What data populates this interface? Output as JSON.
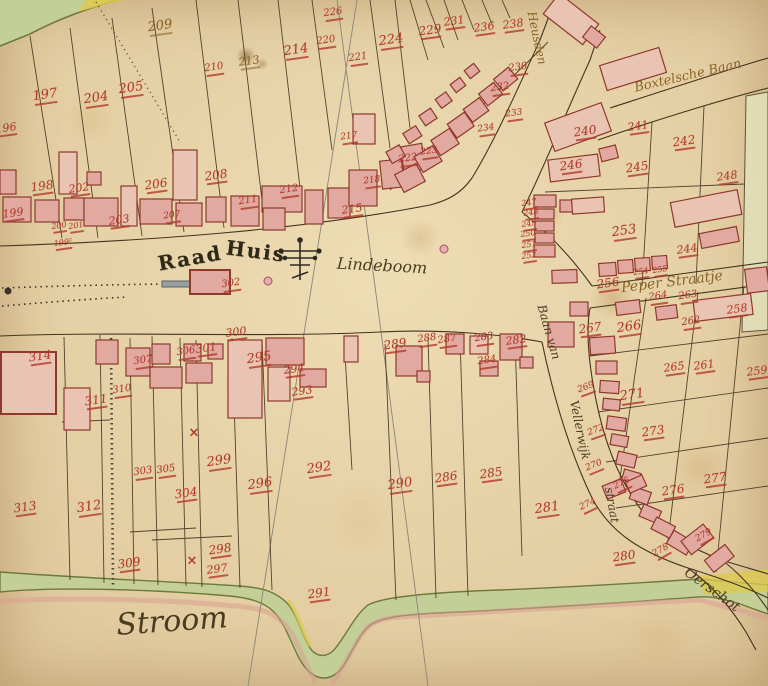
{
  "palette": {
    "paper": "#e7d2a6",
    "line_ink": "#43351f",
    "red_ink": "#b23a2c",
    "brown_ink": "#8a6428",
    "dark_ink": "#332d22",
    "building_fill": "#e2a9a1",
    "building_pale": "#eac4b2",
    "building_stroke": "#8e392e",
    "green_fill": "#c3cf97",
    "green_edge": "#6d7a3a",
    "yellow_fill": "#ddc94e",
    "grey_line": "#8b857a",
    "pink_wash": "#d89e94"
  },
  "map": {
    "place_labels": [
      {
        "name": "raad-huis-label-1",
        "text": "Raad",
        "x": 190,
        "y": 258,
        "rot": -10,
        "size": 20,
        "cls": "blackletter"
      },
      {
        "name": "raad-huis-label-2",
        "text": "Huis",
        "x": 256,
        "y": 251,
        "rot": 7,
        "size": 20,
        "cls": "blackletter"
      },
      {
        "name": "lindeboom-label",
        "text": "Lindeboom",
        "x": 382,
        "y": 266,
        "rot": 3,
        "size": 16,
        "cls": "script"
      },
      {
        "name": "stroom-label",
        "text": "Stroom",
        "x": 172,
        "y": 622,
        "rot": -4,
        "size": 30,
        "cls": "script"
      },
      {
        "name": "peper-straatje-label",
        "text": "Peper Straatje",
        "x": 672,
        "y": 282,
        "rot": -7,
        "size": 14,
        "cls": "script-brown"
      },
      {
        "name": "boxtelsche-baan-label",
        "text": "Boxtelsche Baan",
        "x": 688,
        "y": 76,
        "rot": -13,
        "size": 13,
        "cls": "script-brown"
      },
      {
        "name": "heusden-street-label",
        "text": "Heusden",
        "x": 537,
        "y": 38,
        "rot": 78,
        "size": 12,
        "cls": "script-brown"
      },
      {
        "name": "baan-van-label",
        "text": "Baan van",
        "x": 549,
        "y": 332,
        "rot": 74,
        "size": 12,
        "cls": "script"
      },
      {
        "name": "vellerwijk-label",
        "text": "Vellerwijk",
        "x": 580,
        "y": 430,
        "rot": 78,
        "size": 12,
        "cls": "script"
      },
      {
        "name": "straat-label",
        "text": "straat",
        "x": 612,
        "y": 505,
        "rot": 80,
        "size": 12,
        "cls": "script"
      },
      {
        "name": "oerschot-label",
        "text": "Oerschot",
        "x": 712,
        "y": 590,
        "rot": 36,
        "size": 14,
        "cls": "script"
      }
    ],
    "parcel_numbers": [
      {
        "n": "196",
        "x": 6,
        "y": 128
      },
      {
        "n": "197",
        "x": 45,
        "y": 95,
        "s": 13
      },
      {
        "n": "204",
        "x": 96,
        "y": 98,
        "s": 13
      },
      {
        "n": "205",
        "x": 131,
        "y": 88,
        "s": 13
      },
      {
        "n": "209",
        "x": 160,
        "y": 26,
        "s": 13,
        "cls": "brown"
      },
      {
        "n": "210",
        "x": 214,
        "y": 68,
        "s": 10
      },
      {
        "n": "213",
        "x": 249,
        "y": 61,
        "cls": "brown"
      },
      {
        "n": "214",
        "x": 296,
        "y": 50,
        "s": 13
      },
      {
        "n": "220",
        "x": 326,
        "y": 41,
        "s": 10
      },
      {
        "n": "221",
        "x": 358,
        "y": 58,
        "s": 10
      },
      {
        "n": "226",
        "x": 333,
        "y": 13,
        "s": 10
      },
      {
        "n": "224",
        "x": 391,
        "y": 40,
        "s": 13
      },
      {
        "n": "229",
        "x": 430,
        "y": 30,
        "s": 12
      },
      {
        "n": "231",
        "x": 454,
        "y": 21,
        "s": 11
      },
      {
        "n": "236",
        "x": 484,
        "y": 27,
        "s": 11
      },
      {
        "n": "238",
        "x": 513,
        "y": 24,
        "s": 11
      },
      {
        "n": "230",
        "x": 518,
        "y": 68,
        "s": 10
      },
      {
        "n": "232",
        "x": 500,
        "y": 88,
        "s": 10
      },
      {
        "n": "233",
        "x": 514,
        "y": 114,
        "s": 9
      },
      {
        "n": "234",
        "x": 486,
        "y": 129,
        "s": 9
      },
      {
        "n": "222",
        "x": 408,
        "y": 159,
        "s": 10
      },
      {
        "n": "223",
        "x": 429,
        "y": 152,
        "s": 9
      },
      {
        "n": "217",
        "x": 349,
        "y": 137,
        "s": 9
      },
      {
        "n": "218",
        "x": 372,
        "y": 181,
        "s": 9
      },
      {
        "n": "198",
        "x": 42,
        "y": 186,
        "s": 12
      },
      {
        "n": "199",
        "x": 13,
        "y": 213
      },
      {
        "n": "199²",
        "x": 63,
        "y": 243,
        "s": 8
      },
      {
        "n": "200",
        "x": 59,
        "y": 226,
        "s": 8
      },
      {
        "n": "201",
        "x": 76,
        "y": 226,
        "s": 8
      },
      {
        "n": "202",
        "x": 79,
        "y": 188
      },
      {
        "n": "203",
        "x": 119,
        "y": 220
      },
      {
        "n": "206",
        "x": 156,
        "y": 184,
        "s": 12
      },
      {
        "n": "207",
        "x": 172,
        "y": 216,
        "s": 9
      },
      {
        "n": "208",
        "x": 216,
        "y": 175,
        "s": 12
      },
      {
        "n": "211",
        "x": 248,
        "y": 201,
        "s": 10
      },
      {
        "n": "212",
        "x": 289,
        "y": 190,
        "s": 10
      },
      {
        "n": "215",
        "x": 352,
        "y": 209
      },
      {
        "n": "240",
        "x": 585,
        "y": 131,
        "s": 12
      },
      {
        "n": "241",
        "x": 638,
        "y": 126,
        "s": 11
      },
      {
        "n": "242",
        "x": 684,
        "y": 141,
        "s": 12
      },
      {
        "n": "246",
        "x": 571,
        "y": 165,
        "s": 12
      },
      {
        "n": "245",
        "x": 637,
        "y": 167,
        "s": 12
      },
      {
        "n": "248",
        "x": 727,
        "y": 176
      },
      {
        "n": "247",
        "x": 529,
        "y": 203,
        "s": 8
      },
      {
        "n": "248",
        "x": 531,
        "y": 213,
        "s": 8
      },
      {
        "n": "249",
        "x": 529,
        "y": 224,
        "s": 8
      },
      {
        "n": "250",
        "x": 528,
        "y": 234,
        "s": 8
      },
      {
        "n": "251",
        "x": 529,
        "y": 245,
        "s": 8
      },
      {
        "n": "252",
        "x": 529,
        "y": 256,
        "s": 8
      },
      {
        "n": "253",
        "x": 624,
        "y": 231,
        "s": 13
      },
      {
        "n": "244",
        "x": 687,
        "y": 249,
        "s": 11
      },
      {
        "n": "254",
        "x": 641,
        "y": 272,
        "s": 8
      },
      {
        "n": "255",
        "x": 660,
        "y": 270,
        "s": 8
      },
      {
        "n": "256",
        "x": 608,
        "y": 283,
        "s": 12
      },
      {
        "n": "264",
        "x": 658,
        "y": 297,
        "s": 10
      },
      {
        "n": "263",
        "x": 688,
        "y": 296,
        "s": 10
      },
      {
        "n": "258",
        "x": 737,
        "y": 309
      },
      {
        "n": "262",
        "x": 691,
        "y": 322,
        "s": 10
      },
      {
        "n": "266",
        "x": 629,
        "y": 327,
        "s": 13
      },
      {
        "n": "267",
        "x": 590,
        "y": 328,
        "s": 12
      },
      {
        "n": "265",
        "x": 674,
        "y": 367
      },
      {
        "n": "261",
        "x": 704,
        "y": 365
      },
      {
        "n": "259",
        "x": 757,
        "y": 371
      },
      {
        "n": "271",
        "x": 632,
        "y": 395,
        "s": 13
      },
      {
        "n": "273",
        "x": 653,
        "y": 431,
        "s": 12
      },
      {
        "n": "276",
        "x": 673,
        "y": 490,
        "s": 12
      },
      {
        "n": "277",
        "x": 715,
        "y": 478,
        "s": 12
      },
      {
        "n": "269",
        "x": 586,
        "y": 388,
        "s": 9,
        "rot": -20
      },
      {
        "n": "272",
        "x": 596,
        "y": 431,
        "s": 9,
        "rot": -20
      },
      {
        "n": "270",
        "x": 594,
        "y": 466,
        "s": 9,
        "rot": -22
      },
      {
        "n": "274",
        "x": 588,
        "y": 505,
        "s": 9,
        "rot": -25
      },
      {
        "n": "275",
        "x": 622,
        "y": 484,
        "s": 9,
        "rot": -25
      },
      {
        "n": "278",
        "x": 661,
        "y": 551,
        "s": 9,
        "rot": -30
      },
      {
        "n": "279",
        "x": 704,
        "y": 536,
        "s": 9,
        "rot": -30
      },
      {
        "n": "280",
        "x": 624,
        "y": 556,
        "s": 12
      },
      {
        "n": "281",
        "x": 547,
        "y": 508,
        "s": 13
      },
      {
        "n": "282",
        "x": 516,
        "y": 340
      },
      {
        "n": "283",
        "x": 484,
        "y": 338,
        "s": 10
      },
      {
        "n": "284",
        "x": 487,
        "y": 361,
        "s": 10
      },
      {
        "n": "287",
        "x": 447,
        "y": 340,
        "s": 10
      },
      {
        "n": "288",
        "x": 427,
        "y": 339,
        "s": 10
      },
      {
        "n": "289",
        "x": 395,
        "y": 344,
        "s": 12
      },
      {
        "n": "290",
        "x": 400,
        "y": 484,
        "s": 13
      },
      {
        "n": "286",
        "x": 446,
        "y": 477,
        "s": 12
      },
      {
        "n": "285",
        "x": 491,
        "y": 473,
        "s": 12
      },
      {
        "n": "291",
        "x": 319,
        "y": 593,
        "s": 12
      },
      {
        "n": "292",
        "x": 319,
        "y": 468,
        "s": 13
      },
      {
        "n": "293",
        "x": 302,
        "y": 391
      },
      {
        "n": "294",
        "x": 294,
        "y": 369
      },
      {
        "n": "295",
        "x": 259,
        "y": 358,
        "s": 13
      },
      {
        "n": "296",
        "x": 260,
        "y": 484,
        "s": 13
      },
      {
        "n": "297",
        "x": 217,
        "y": 569
      },
      {
        "n": "298",
        "x": 220,
        "y": 549,
        "s": 12
      },
      {
        "n": "299",
        "x": 219,
        "y": 461,
        "s": 13
      },
      {
        "n": "300",
        "x": 236,
        "y": 332
      },
      {
        "n": "301",
        "x": 206,
        "y": 348
      },
      {
        "n": "302",
        "x": 231,
        "y": 284,
        "s": 10
      },
      {
        "n": "303",
        "x": 143,
        "y": 472,
        "s": 10
      },
      {
        "n": "305",
        "x": 166,
        "y": 470,
        "s": 10
      },
      {
        "n": "304",
        "x": 186,
        "y": 493,
        "s": 12
      },
      {
        "n": "306",
        "x": 186,
        "y": 352,
        "s": 10
      },
      {
        "n": "307",
        "x": 143,
        "y": 361,
        "s": 10
      },
      {
        "n": "309",
        "x": 129,
        "y": 563,
        "s": 12
      },
      {
        "n": "310",
        "x": 122,
        "y": 390,
        "s": 10
      },
      {
        "n": "311",
        "x": 96,
        "y": 400,
        "s": 12
      },
      {
        "n": "312",
        "x": 89,
        "y": 507,
        "s": 13
      },
      {
        "n": "313",
        "x": 25,
        "y": 507,
        "s": 12
      },
      {
        "n": "314",
        "x": 40,
        "y": 356,
        "s": 12
      }
    ],
    "symbols": {
      "cross_glyph": "×",
      "cross_marks": [
        {
          "x": 194,
          "y": 433
        },
        {
          "x": 192,
          "y": 561
        }
      ],
      "dots": [
        {
          "x": 268,
          "y": 281,
          "type": "well"
        },
        {
          "x": 444,
          "y": 249,
          "type": "well"
        },
        {
          "x": 8,
          "y": 291,
          "type": "mark"
        }
      ]
    }
  }
}
